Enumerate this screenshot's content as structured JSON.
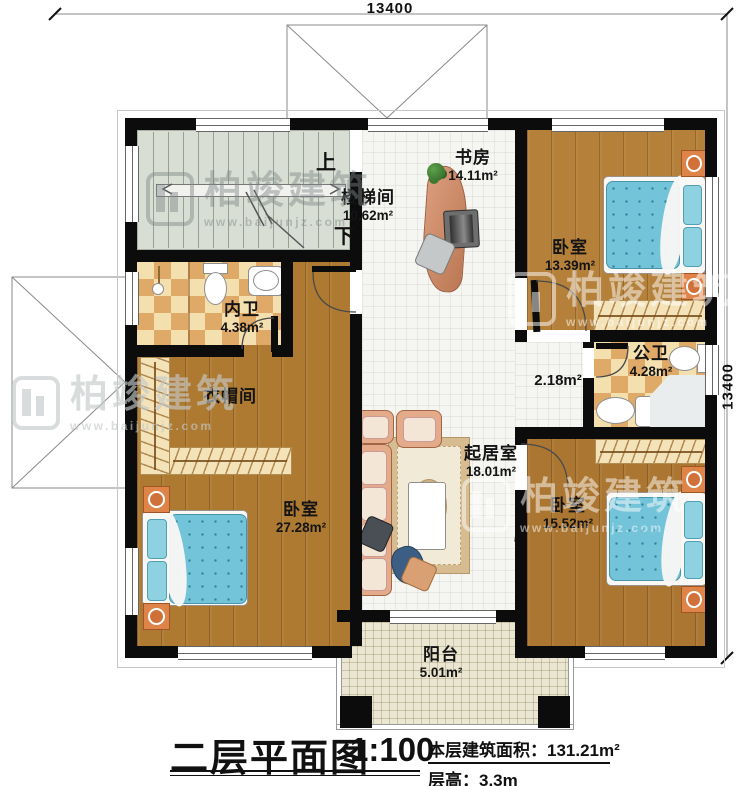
{
  "dimensions": {
    "top": "13400",
    "right": "13400"
  },
  "rooms": {
    "stairwell": {
      "name": "楼梯间",
      "area": "10.62m²"
    },
    "study": {
      "name": "书房",
      "area": "14.11m²"
    },
    "bedroom_ne": {
      "name": "卧室",
      "area": "13.39m²"
    },
    "bath_inner": {
      "name": "内卫",
      "area": "4.38m²"
    },
    "cloakroom": {
      "name": "衣帽间"
    },
    "bedroom_sw": {
      "name": "卧室",
      "area": "27.28m²"
    },
    "living": {
      "name": "起居室",
      "area": "18.01m²"
    },
    "hall": {
      "area": "2.18m²"
    },
    "bath_public": {
      "name": "公卫",
      "area": "4.28m²"
    },
    "bedroom_se": {
      "name": "卧室",
      "area": "15.52m²"
    },
    "balcony": {
      "name": "阳台",
      "area": "5.01m²"
    }
  },
  "stairs": {
    "up": "上",
    "down": "下"
  },
  "watermark": {
    "brand": "柏竣建筑",
    "url": "www.baijunjz.com"
  },
  "titleblock": {
    "title": "二层平面图",
    "scale": "1:100",
    "area_label": "本层建筑面积：",
    "area_value": "131.21m²",
    "floor_height_label": "层高：",
    "floor_height_value": "3.3m"
  },
  "colors": {
    "wall": "#0c0c0c",
    "wood": "#ae7a32",
    "tile": "#f5f5f2",
    "checker_dark": "#dfa968",
    "checker_light": "#f4dfae",
    "quilt_blue": "#73c3d9",
    "nightstand_orange": "#de8449"
  }
}
